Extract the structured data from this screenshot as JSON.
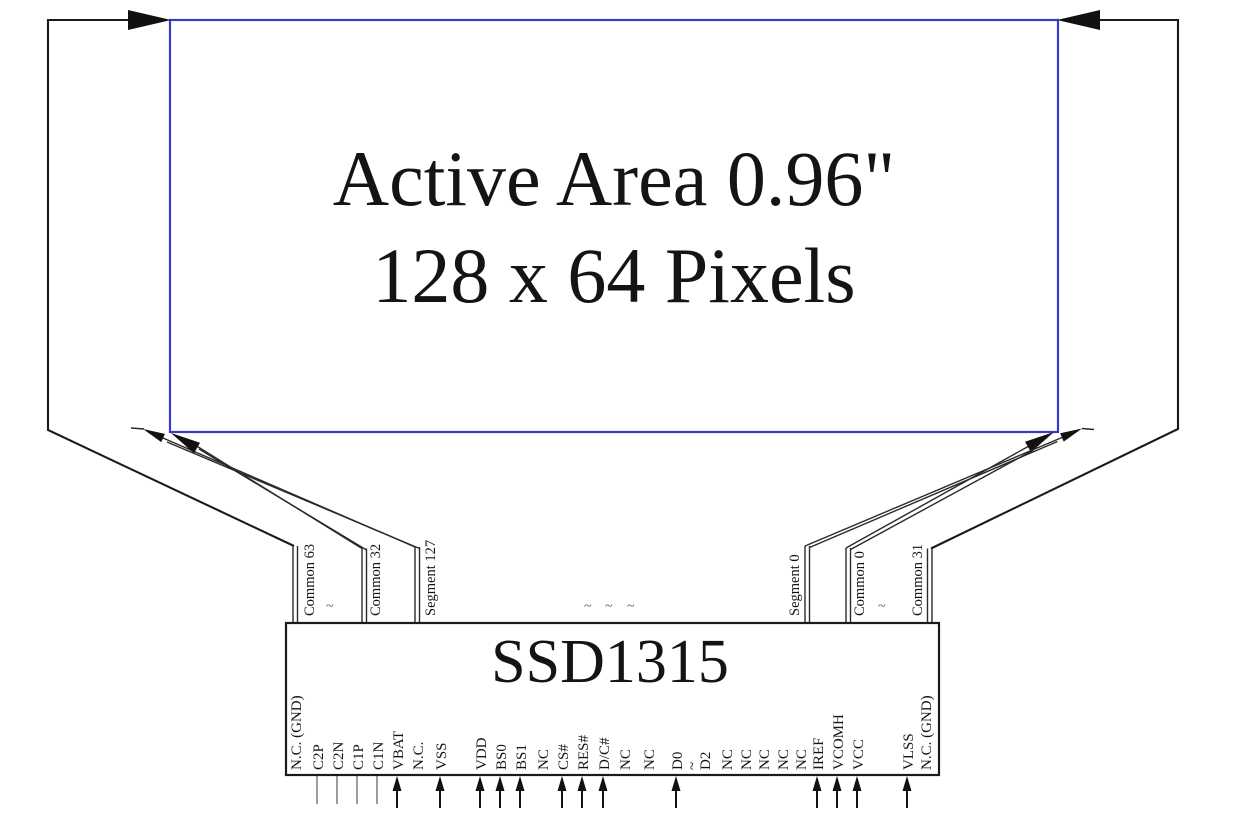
{
  "title": {
    "line1": "Active Area 0.96\"",
    "line2": "128 x 64 Pixels"
  },
  "ic": {
    "name": "SSD1315"
  },
  "top_pads": {
    "left": [
      "Common 63",
      "~",
      "Common 32",
      "Segment 127"
    ],
    "middle_ellipsis": [
      "~",
      "~",
      "~"
    ],
    "right": [
      "Segment 0",
      "Common 0",
      "~",
      "Common 31"
    ]
  },
  "bottom_pins": [
    {
      "label": "N.C. (GND)",
      "connector": "none"
    },
    {
      "label": "C2P",
      "connector": "line"
    },
    {
      "label": "C2N",
      "connector": "line"
    },
    {
      "label": "C1P",
      "connector": "line"
    },
    {
      "label": "C1N",
      "connector": "line"
    },
    {
      "label": "VBAT",
      "connector": "arrow"
    },
    {
      "label": "N.C.",
      "connector": "none"
    },
    {
      "label": "VSS",
      "connector": "arrow"
    },
    {
      "label": "VDD",
      "connector": "arrow"
    },
    {
      "label": "BS0",
      "connector": "arrow"
    },
    {
      "label": "BS1",
      "connector": "arrow"
    },
    {
      "label": "NC",
      "connector": "none"
    },
    {
      "label": "CS#",
      "connector": "arrow"
    },
    {
      "label": "RES#",
      "connector": "arrow"
    },
    {
      "label": "D/C#",
      "connector": "arrow"
    },
    {
      "label": "NC",
      "connector": "none"
    },
    {
      "label": "NC",
      "connector": "none"
    },
    {
      "label": "D0",
      "connector": "arrow"
    },
    {
      "label": "~",
      "connector": "none"
    },
    {
      "label": "D2",
      "connector": "none"
    },
    {
      "label": "NC",
      "connector": "none"
    },
    {
      "label": "NC",
      "connector": "none"
    },
    {
      "label": "NC",
      "connector": "none"
    },
    {
      "label": "NC",
      "connector": "none"
    },
    {
      "label": "NC",
      "connector": "none"
    },
    {
      "label": "IREF",
      "connector": "arrow"
    },
    {
      "label": "VCOMH",
      "connector": "arrow"
    },
    {
      "label": "VCC",
      "connector": "arrow"
    },
    {
      "label": "VLSS",
      "connector": "arrow"
    },
    {
      "label": "N.C. (GND)",
      "connector": "none"
    }
  ],
  "colors": {
    "active_area_border": "#3a3ad0",
    "line": "#1a1a1a",
    "nc_line": "#8a8a8a",
    "background": "#ffffff"
  }
}
